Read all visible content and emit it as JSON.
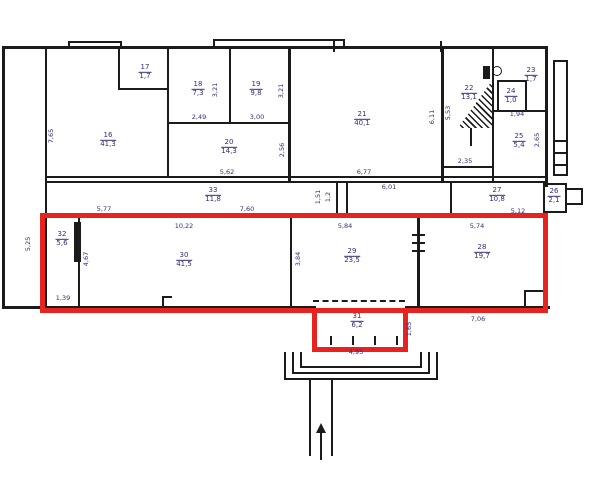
{
  "colors": {
    "highlight_red": "#e8231f",
    "wall": "#1b1b1b",
    "label": "#2f2f7a"
  },
  "rooms": [
    {
      "number": "16",
      "area": "41,3",
      "x": 108,
      "y": 140
    },
    {
      "number": "17",
      "area": "1,7",
      "x": 145,
      "y": 72
    },
    {
      "number": "18",
      "area": "7,3",
      "x": 198,
      "y": 89
    },
    {
      "number": "19",
      "area": "9,8",
      "x": 256,
      "y": 89
    },
    {
      "number": "20",
      "area": "14,3",
      "x": 229,
      "y": 147
    },
    {
      "number": "21",
      "area": "40,1",
      "x": 362,
      "y": 119
    },
    {
      "number": "22",
      "area": "13,1",
      "x": 469,
      "y": 93
    },
    {
      "number": "23",
      "area": "1,7",
      "x": 531,
      "y": 75
    },
    {
      "number": "24",
      "area": "1,0",
      "x": 511,
      "y": 96
    },
    {
      "number": "25",
      "area": "5,4",
      "x": 519,
      "y": 141
    },
    {
      "number": "26",
      "area": "2,1",
      "x": 554,
      "y": 196
    },
    {
      "number": "27",
      "area": "10,8",
      "x": 497,
      "y": 195
    },
    {
      "number": "28",
      "area": "19,7",
      "x": 482,
      "y": 252
    },
    {
      "number": "29",
      "area": "23,5",
      "x": 352,
      "y": 256
    },
    {
      "number": "30",
      "area": "41,5",
      "x": 184,
      "y": 260
    },
    {
      "number": "31",
      "area": "6,2",
      "x": 357,
      "y": 321
    },
    {
      "number": "32",
      "area": "5,6",
      "x": 62,
      "y": 239
    },
    {
      "number": "33",
      "area": "11,8",
      "x": 213,
      "y": 195
    }
  ],
  "dimensions": [
    {
      "text": "7,65",
      "x": 51,
      "y": 136,
      "vertical": true
    },
    {
      "text": "5,25",
      "x": 28,
      "y": 244,
      "vertical": true
    },
    {
      "text": "5,77",
      "x": 104,
      "y": 209,
      "vertical": false
    },
    {
      "text": "10,22",
      "x": 184,
      "y": 226,
      "vertical": false
    },
    {
      "text": "5,84",
      "x": 345,
      "y": 226,
      "vertical": false
    },
    {
      "text": "5,74",
      "x": 477,
      "y": 226,
      "vertical": false
    },
    {
      "text": "2,49",
      "x": 199,
      "y": 117,
      "vertical": false
    },
    {
      "text": "3,00",
      "x": 257,
      "y": 117,
      "vertical": false
    },
    {
      "text": "3,21",
      "x": 215,
      "y": 90,
      "vertical": true
    },
    {
      "text": "3,21",
      "x": 281,
      "y": 91,
      "vertical": true
    },
    {
      "text": "5,62",
      "x": 227,
      "y": 172,
      "vertical": false
    },
    {
      "text": "2,56",
      "x": 282,
      "y": 150,
      "vertical": true
    },
    {
      "text": "6,77",
      "x": 364,
      "y": 172,
      "vertical": false
    },
    {
      "text": "6,11",
      "x": 432,
      "y": 117,
      "vertical": true
    },
    {
      "text": "5,53",
      "x": 448,
      "y": 113,
      "vertical": true
    },
    {
      "text": "2,35",
      "x": 465,
      "y": 161,
      "vertical": false
    },
    {
      "text": "1,94",
      "x": 517,
      "y": 114,
      "vertical": false
    },
    {
      "text": "2,65",
      "x": 537,
      "y": 140,
      "vertical": true
    },
    {
      "text": "7,60",
      "x": 247,
      "y": 209,
      "vertical": false
    },
    {
      "text": "6,01",
      "x": 389,
      "y": 187,
      "vertical": false
    },
    {
      "text": "1,51",
      "x": 318,
      "y": 197,
      "vertical": true
    },
    {
      "text": "1,2",
      "x": 328,
      "y": 197,
      "vertical": true
    },
    {
      "text": "5,12",
      "x": 518,
      "y": 211,
      "vertical": false
    },
    {
      "text": "4,67",
      "x": 86,
      "y": 259,
      "vertical": true
    },
    {
      "text": "3,84",
      "x": 298,
      "y": 259,
      "vertical": true
    },
    {
      "text": "1,39",
      "x": 63,
      "y": 298,
      "vertical": false
    },
    {
      "text": "7,06",
      "x": 478,
      "y": 319,
      "vertical": false
    },
    {
      "text": "1,65",
      "x": 409,
      "y": 329,
      "vertical": true
    },
    {
      "text": "4,95",
      "x": 356,
      "y": 352,
      "vertical": false
    }
  ]
}
